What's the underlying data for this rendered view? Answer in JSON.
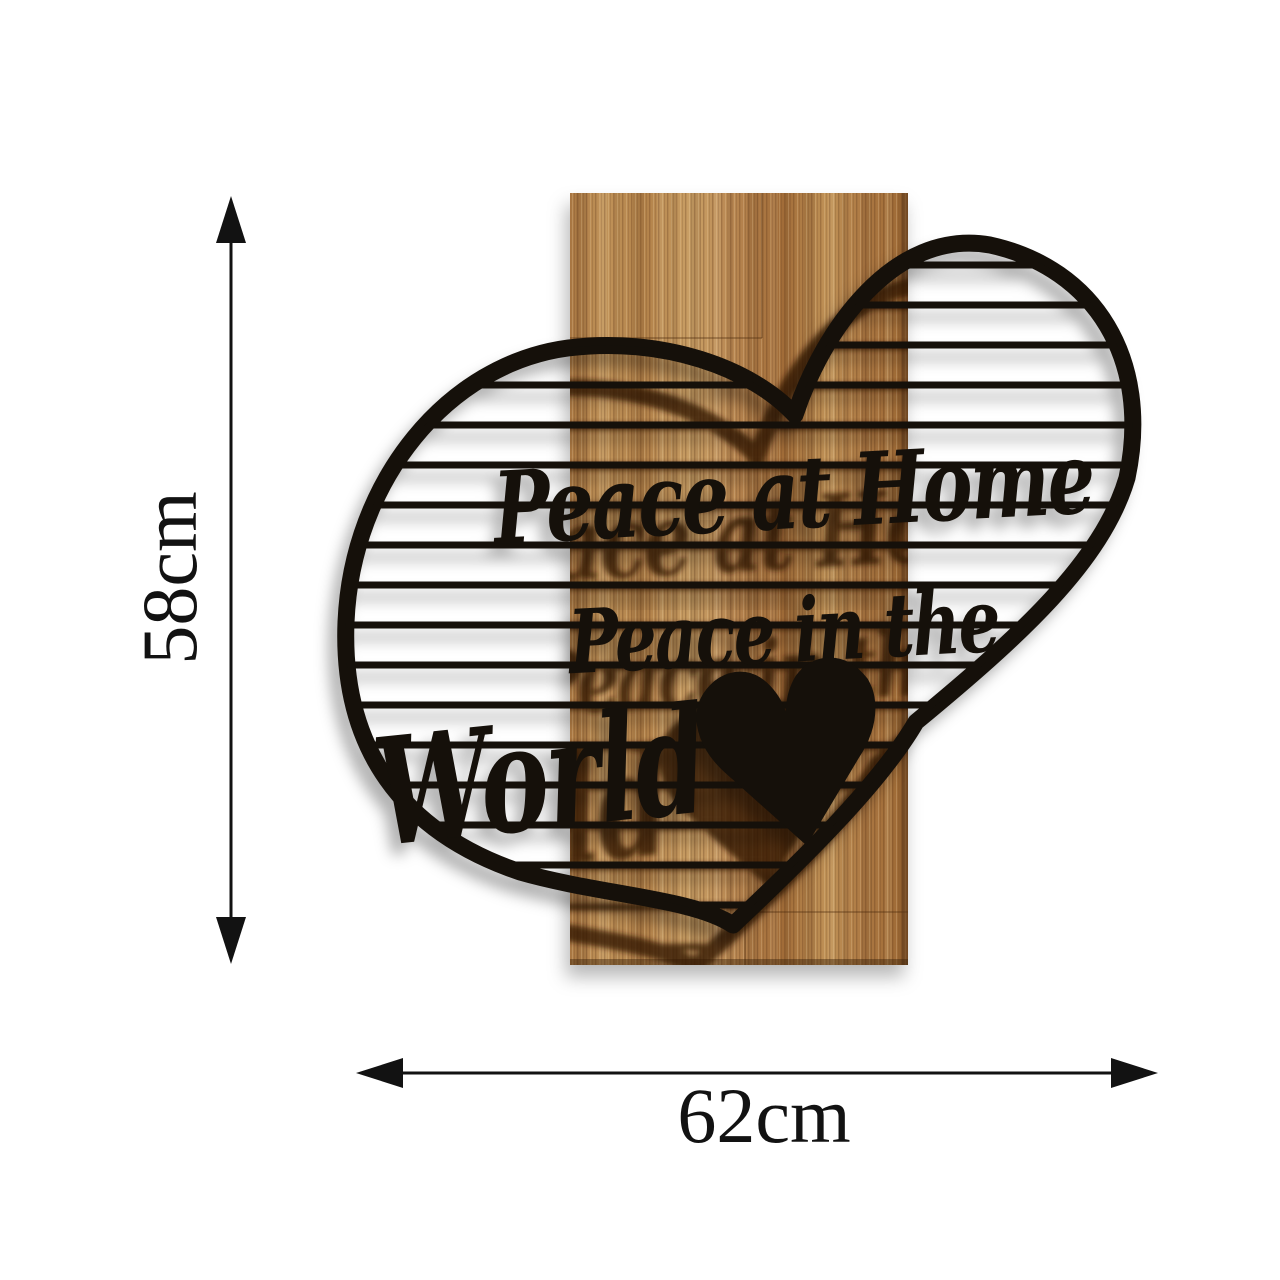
{
  "dimensions": {
    "height_label": "58cm",
    "width_label": "62cm"
  },
  "artwork": {
    "line1": "Peace at Home",
    "line2": "Peace in the",
    "line3": "World"
  },
  "icons": {
    "heart_glyph": "♥"
  },
  "colors": {
    "background": "#ffffff",
    "metal": "#15100a",
    "engraving": "#331705",
    "wood_light": "#c99a60",
    "wood_mid": "#b28049",
    "wood_dark": "#8a5a2e",
    "dimension": "#121212"
  }
}
